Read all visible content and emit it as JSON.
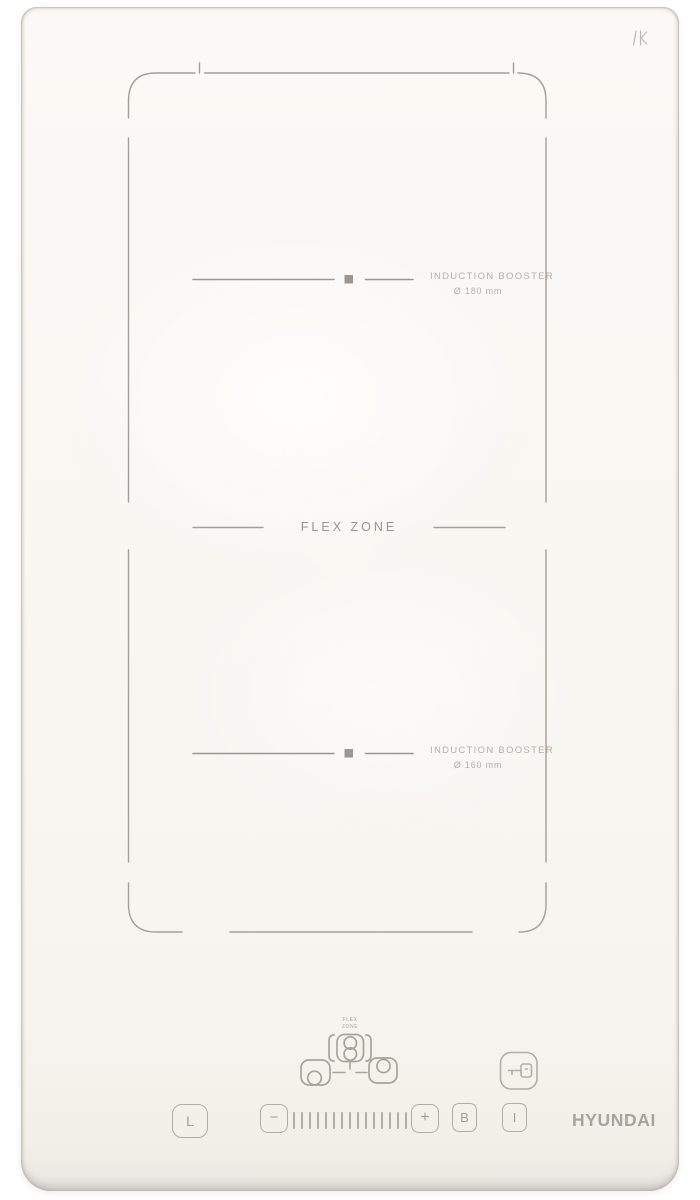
{
  "branding": {
    "logo": "HYUNDAI",
    "etched_mark": "K"
  },
  "surface": {
    "flex_zone_label": "FLEX ZONE",
    "zone_top": {
      "booster_label": "INDUCTION BOOSTER",
      "diameter_label": "Ø 180 mm"
    },
    "zone_bottom": {
      "booster_label": "INDUCTION BOOSTER",
      "diameter_label": "Ø 160 mm"
    }
  },
  "control_panel": {
    "flex_zone_key_label": {
      "line1": "FLEX",
      "line2": "ZONE"
    },
    "timer_key": "L",
    "minus_key": "−",
    "plus_key": "+",
    "booster_key": "B",
    "power_key": "I",
    "power_slider_ticks": 15
  },
  "colors": {
    "glass": "#f8f6f2",
    "etch_line": "#a49f98",
    "etch_text": "#b4afa7",
    "logo_gray": "#a7a39e"
  }
}
